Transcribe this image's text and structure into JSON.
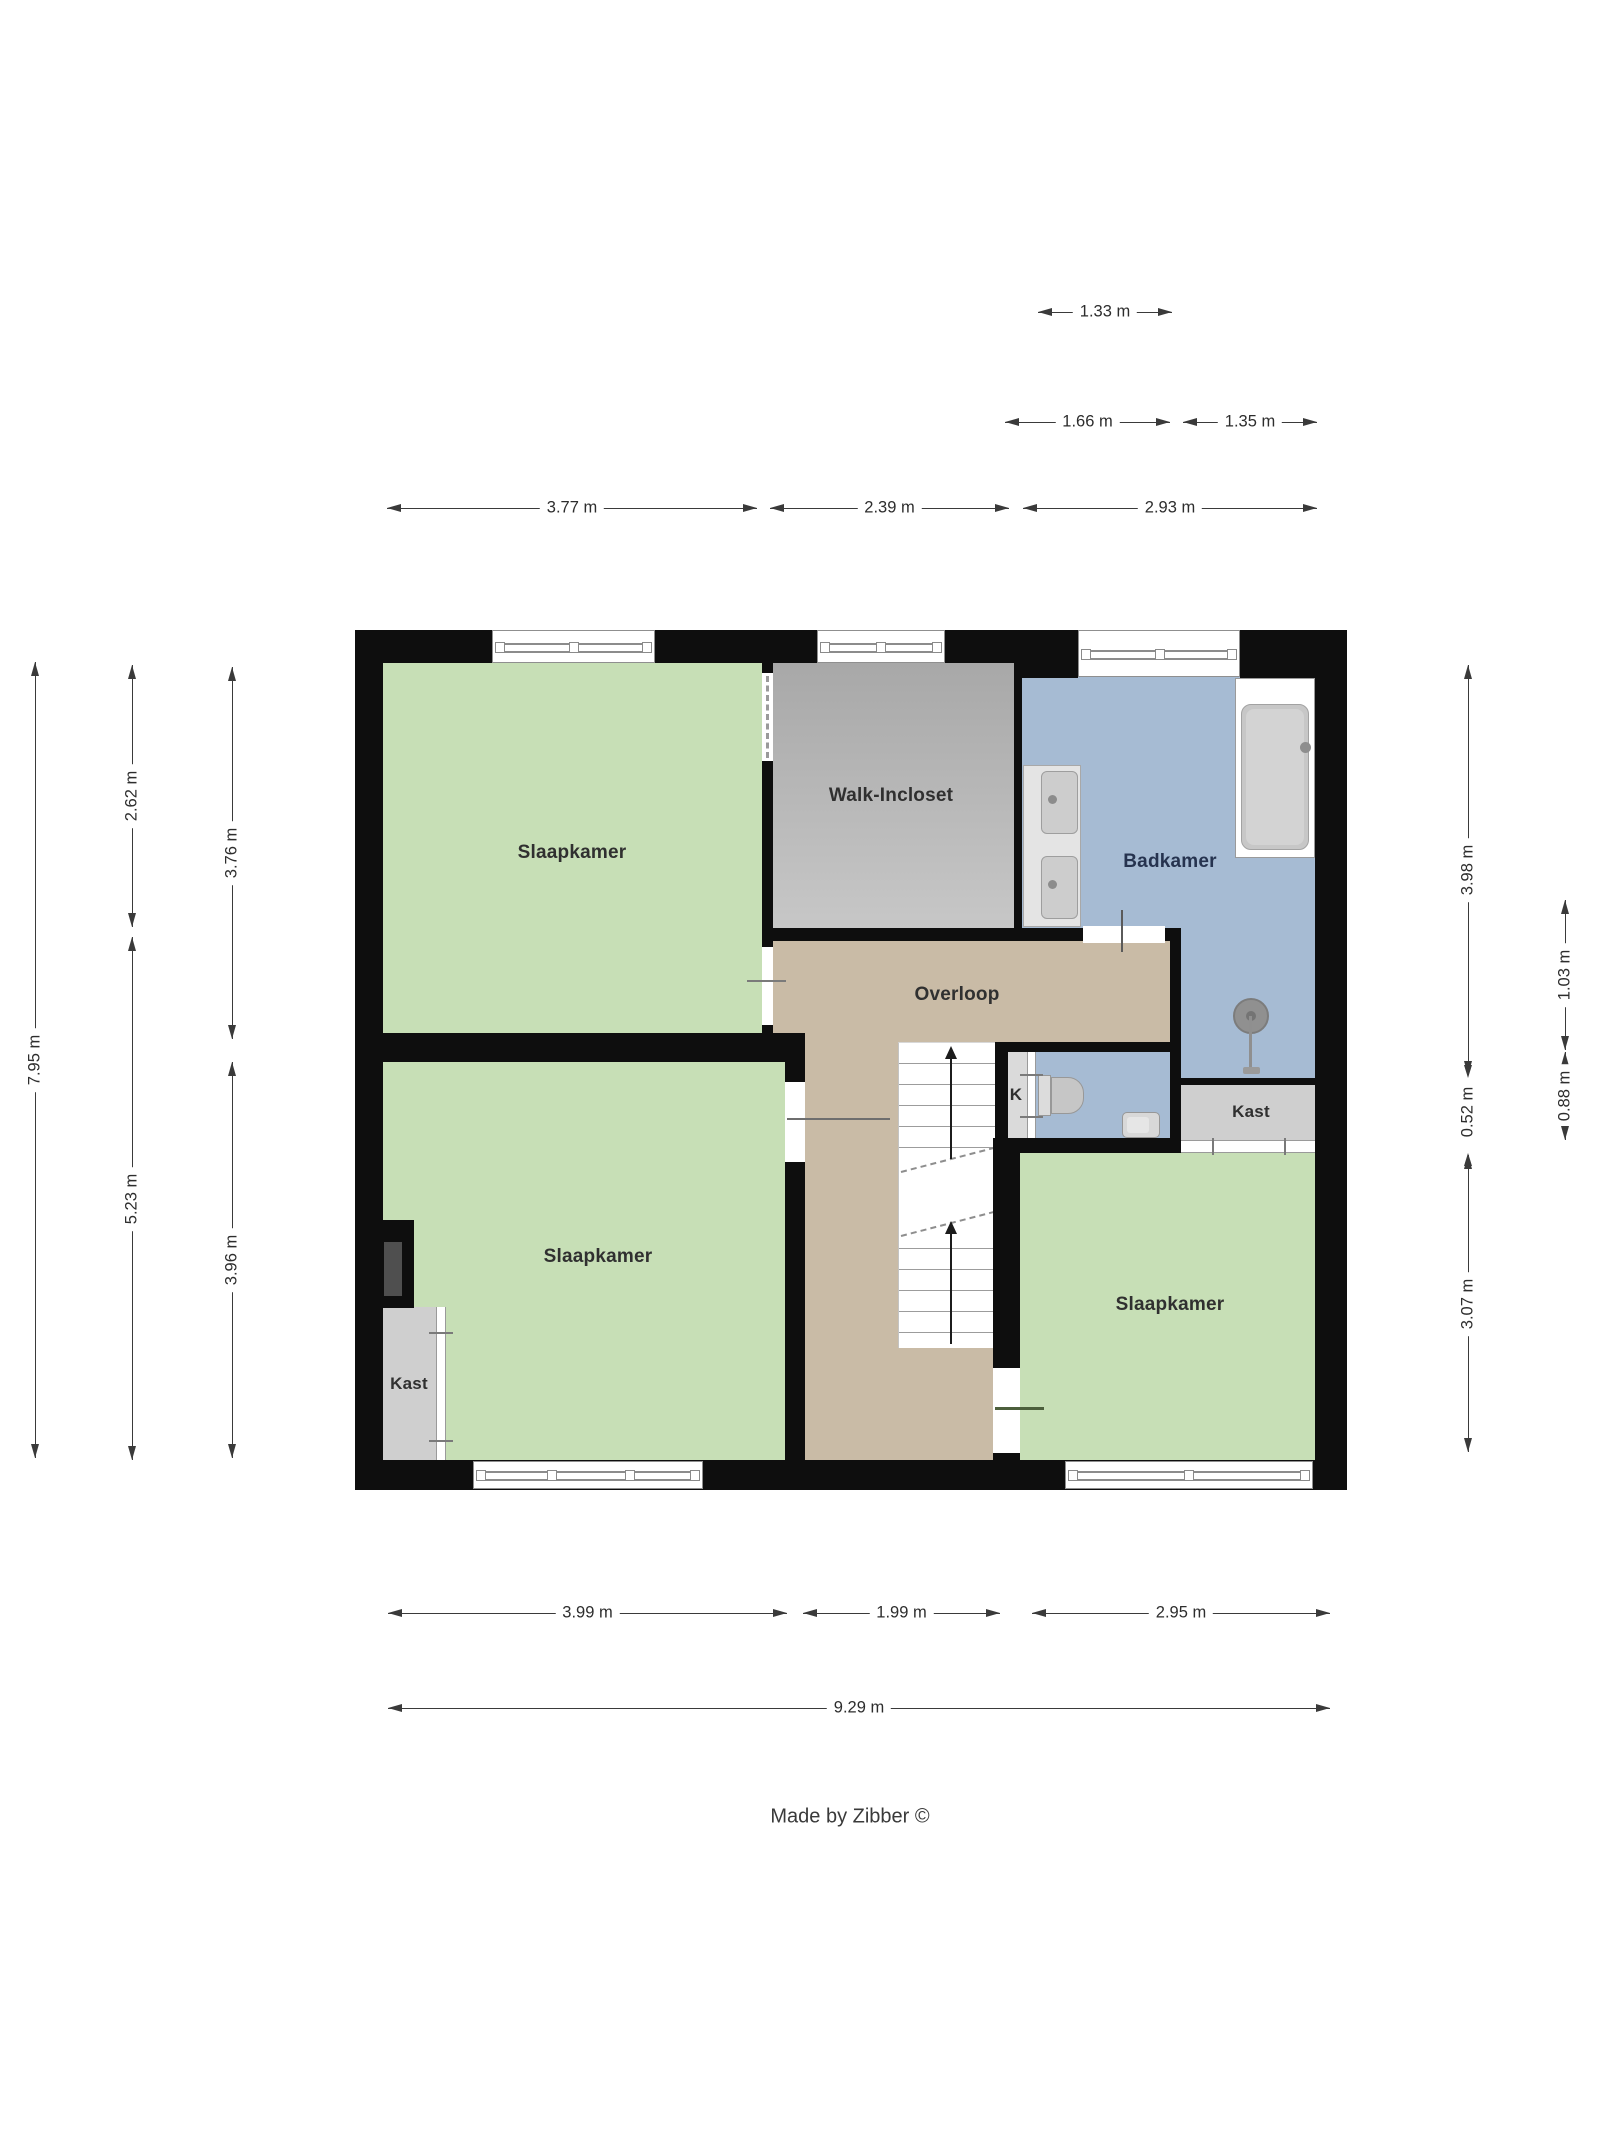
{
  "rooms": {
    "slaapkamer_tl": {
      "label": "Slaapkamer"
    },
    "walk_incloset": {
      "label": "Walk-Incloset"
    },
    "badkamer": {
      "label": "Badkamer"
    },
    "overloop": {
      "label": "Overloop"
    },
    "toilet": {
      "label": "K"
    },
    "kast_right": {
      "label": "Kast"
    },
    "slaapkamer_bl": {
      "label": "Slaapkamer"
    },
    "kast_left": {
      "label": "Kast"
    },
    "slaapkamer_br": {
      "label": "Slaapkamer"
    }
  },
  "dimensions": {
    "top": {
      "w1_33": "1.33 m",
      "w1_66": "1.66 m",
      "w1_35": "1.35 m",
      "w3_77": "3.77 m",
      "w2_39": "2.39 m",
      "w2_93": "2.93 m"
    },
    "bottom": {
      "w3_99": "3.99 m",
      "w1_99": "1.99 m",
      "w2_95": "2.95 m",
      "w9_29": "9.29 m"
    },
    "left": {
      "h7_95": "7.95 m",
      "h2_62": "2.62 m",
      "h5_23": "5.23 m",
      "h3_76": "3.76 m",
      "h3_96": "3.96 m"
    },
    "right": {
      "h3_98": "3.98 m",
      "h0_52": "0.52 m",
      "h3_07": "3.07 m",
      "h1_03": "1.03 m",
      "h0_88": "0.88 m"
    }
  },
  "footer": {
    "credit": "Made by Zibber ©"
  },
  "colors": {
    "bedroom_green": "#c7dfb6",
    "hall_tan": "#c9bba6",
    "bath_blue": "#a6bbd3",
    "walkin_gray_top": "#a8a8a8",
    "walkin_gray_bottom": "#c7c7c7",
    "closet_gray": "#cfcfcf",
    "wall_black": "#0e0e0e",
    "badkamer_label": "#26334f",
    "label_dark": "#303030"
  }
}
